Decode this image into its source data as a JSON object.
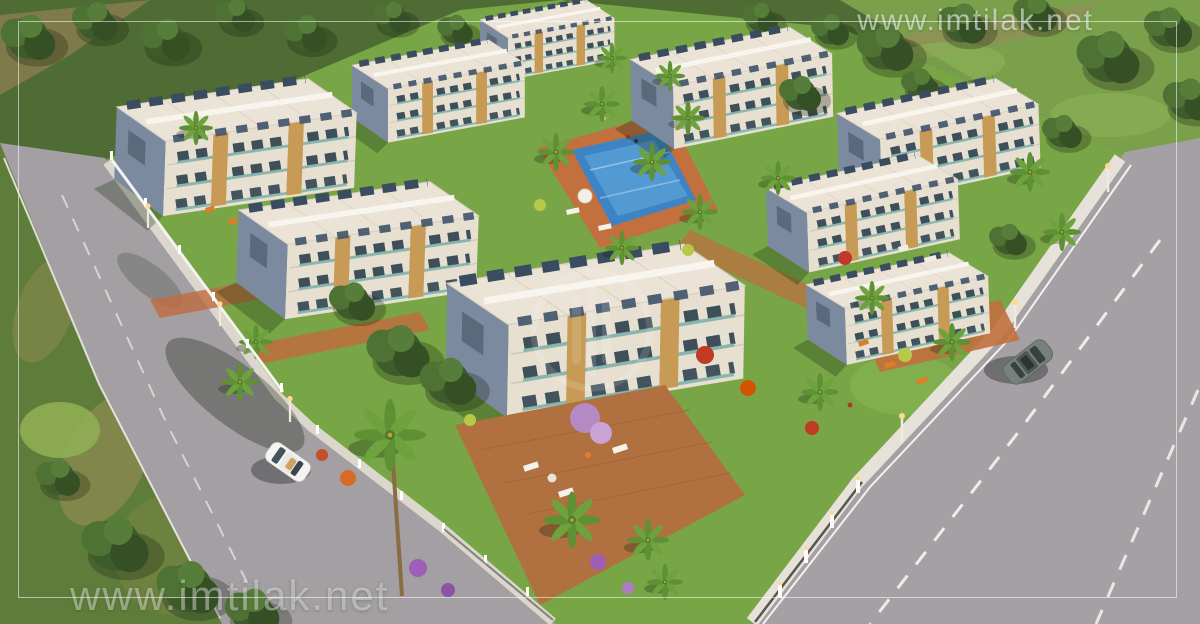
{
  "scene": {
    "alt": "Aerial 3D architectural rendering of a gated residential complex: nine white low-rise apartment blocks with roof terraces and wood accents, lawns, palm trees, a swimming pool, perimeter roads with a white car and a gray car",
    "buildings_visible": 9,
    "cars": [
      "white-sedan-left-road",
      "gray-sedan-right-road"
    ]
  },
  "watermarks": {
    "top_right": "www.imtilak.net",
    "bottom_left": "www.imtilak.net",
    "center_logo_icon": "imtilak-circular-logo-watermark"
  },
  "palette": {
    "vegetation_dark": "#3e5c2b",
    "park_green": "#7ba04c",
    "lawn": "#78a646",
    "meadow": "#5f7d3a",
    "road": "#a39fa3",
    "sidewalk": "#e6e2d9",
    "roof": "#ece3d7",
    "facade": "#e7e0d1",
    "building_side": "#7c8aa0",
    "wood_accent": "#c79b55",
    "glass_teal": "#7fb3ac",
    "solar_panel": "#3a4c60",
    "pool": "#3e84c4",
    "deck_terracotta": "#c1703e",
    "watermark": "#ffffff"
  }
}
